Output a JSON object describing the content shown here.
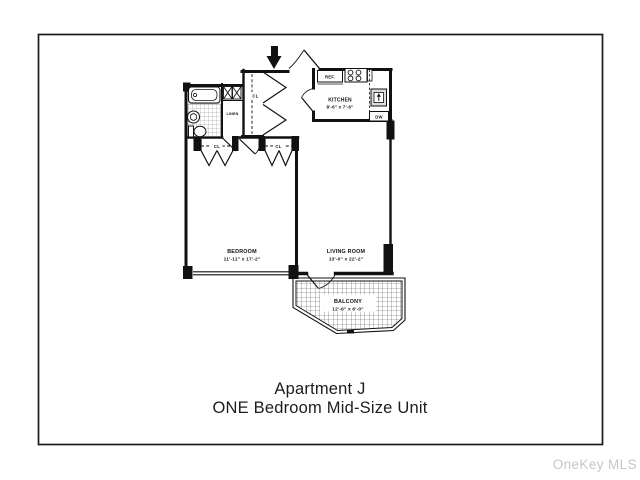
{
  "caption": {
    "line1": "Apartment J",
    "line2": "ONE Bedroom Mid-Size Unit"
  },
  "watermark": "OneKey MLS",
  "floorplan": {
    "rooms": {
      "kitchen": {
        "name": "KITCHEN",
        "dims": "8'-6\" x 7'-6\""
      },
      "bedroom": {
        "name": "BEDROOM",
        "dims": "11'-11\" x 17'-2\""
      },
      "living_room": {
        "name": "LIVING ROOM",
        "dims": "13'-0\" x 22'-2\""
      },
      "balcony": {
        "name": "BALCONY",
        "dims": "12'-6\" x 6'-0\""
      }
    },
    "labels": {
      "linen": "LINEN",
      "closet": "CL",
      "refrigerator": "REF.",
      "dishwasher": "DW"
    },
    "colors": {
      "ink": "#111111",
      "watermark": "#c6c6c8",
      "background": "#ffffff"
    }
  }
}
